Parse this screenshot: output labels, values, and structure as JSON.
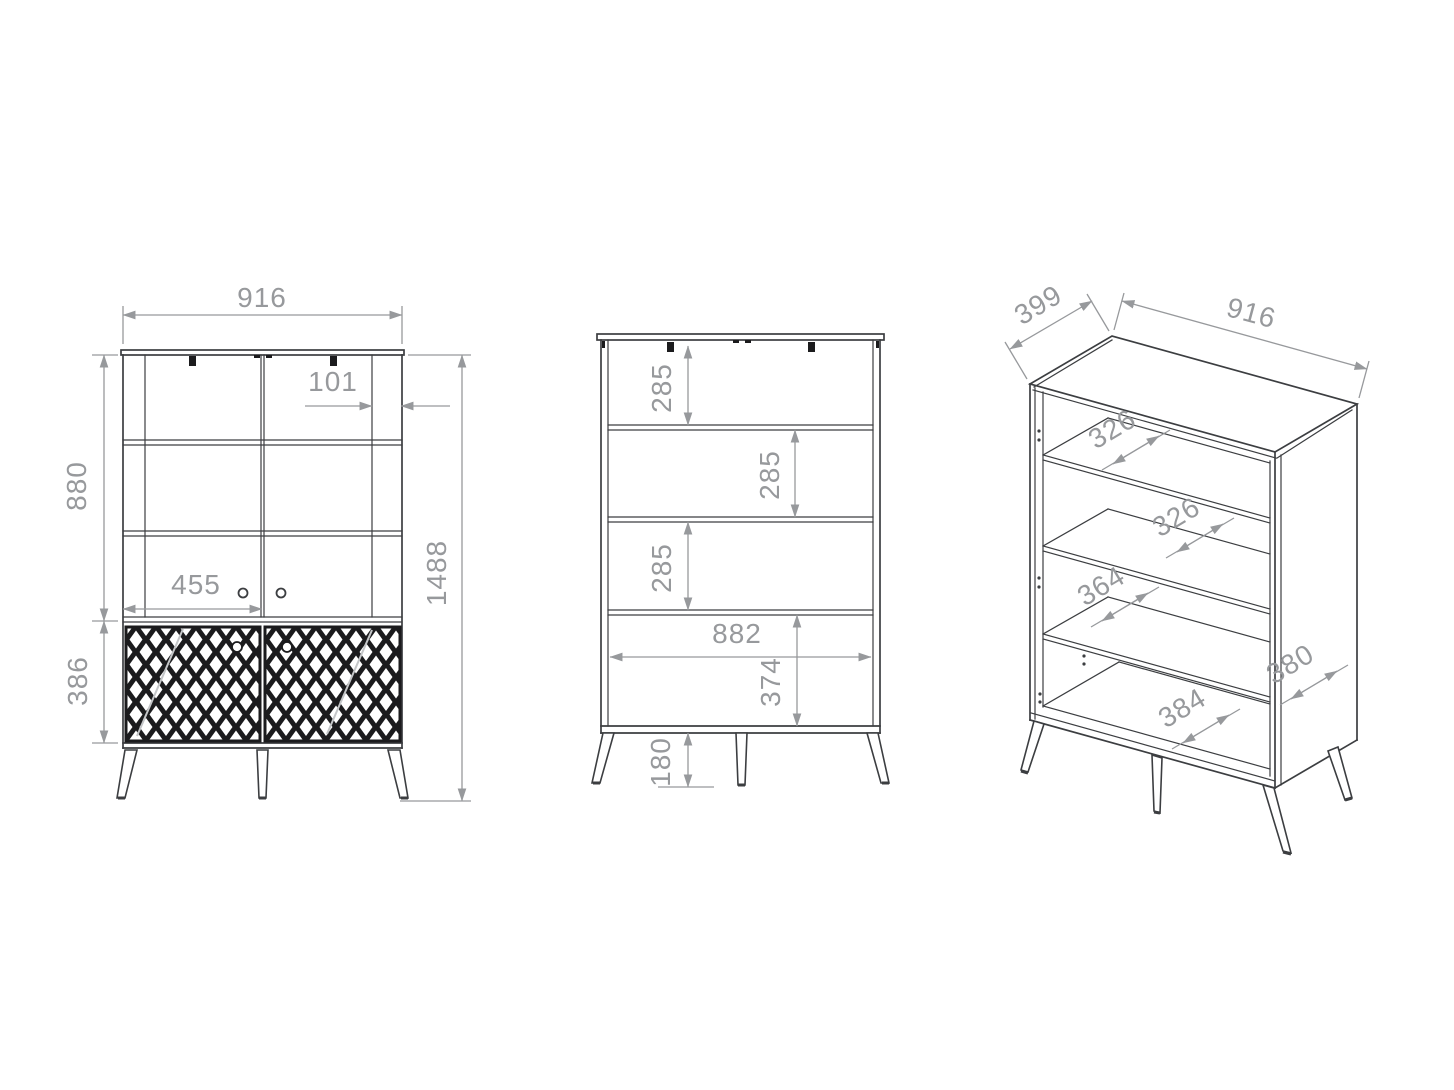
{
  "views": {
    "front": {
      "dim_width": "916",
      "dim_upper_height": "880",
      "dim_frame_width": "101",
      "dim_door_width": "455",
      "dim_lower_height": "386",
      "dim_total_height": "1488"
    },
    "back": {
      "dim_shelf_gap_1": "285",
      "dim_shelf_gap_2": "285",
      "dim_shelf_gap_3": "285",
      "dim_inner_width": "882",
      "dim_bottom_section": "374",
      "dim_leg_height": "180"
    },
    "isometric": {
      "dim_depth": "399",
      "dim_width": "916",
      "dim_shelf_depth_1": "326",
      "dim_shelf_depth_2": "326",
      "dim_shelf_depth_3": "364",
      "dim_bottom_depth": "384",
      "dim_side_depth": "380"
    }
  },
  "colors": {
    "furniture_line": "#3c3e41",
    "dimension_line": "#97999c",
    "lattice_fill": "#1b1b1d",
    "background": "#ffffff"
  }
}
